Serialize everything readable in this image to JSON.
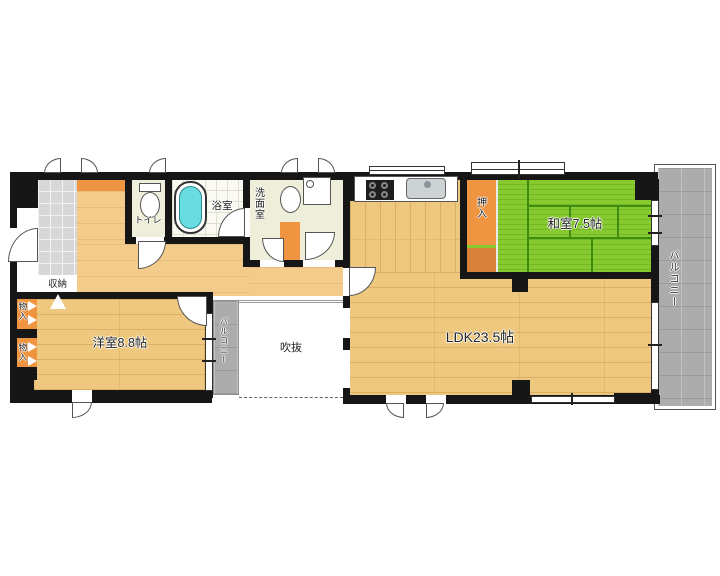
{
  "rooms": {
    "ldk": {
      "label": "LDK23.5帖"
    },
    "washitsu": {
      "label": "和室7.5帖"
    },
    "youshitsu": {
      "label": "洋室8.8帖"
    },
    "fukinuke": {
      "label": "吹抜"
    },
    "toilet": {
      "label": "トイレ"
    },
    "bath": {
      "label": "浴室"
    },
    "washroom": {
      "label": "洗面室"
    },
    "oshiire": {
      "label": "押入"
    },
    "shuunou": {
      "label": "収納"
    },
    "monoire_upper": {
      "label": "物入"
    },
    "monoire_lower": {
      "label": "物入"
    },
    "balcony_right": {
      "label": "バルコニー"
    },
    "balcony_middle": {
      "label": "バルコニー"
    }
  },
  "icons": {
    "toilet": "toilet-icon",
    "bathtub": "bathtub-icon",
    "washbasin": "washbasin-icon",
    "washing_machine": "washing-machine-icon",
    "stove": "stove-icon",
    "kitchen_sink": "kitchen-sink-icon"
  },
  "colors": {
    "floor_wood": "#eec87e",
    "hall_wood": "#f3cb8b",
    "tatami_green": "#86ca30",
    "closet_orange": "#ef9440",
    "closet_orange_dark": "#d8813a",
    "balcony_gray": "#acacac",
    "room_cream": "#eeeeda",
    "entrance_tile": "#d7d7d7",
    "bathtub_cyan": "#68dce0",
    "wall_black": "#161616"
  }
}
